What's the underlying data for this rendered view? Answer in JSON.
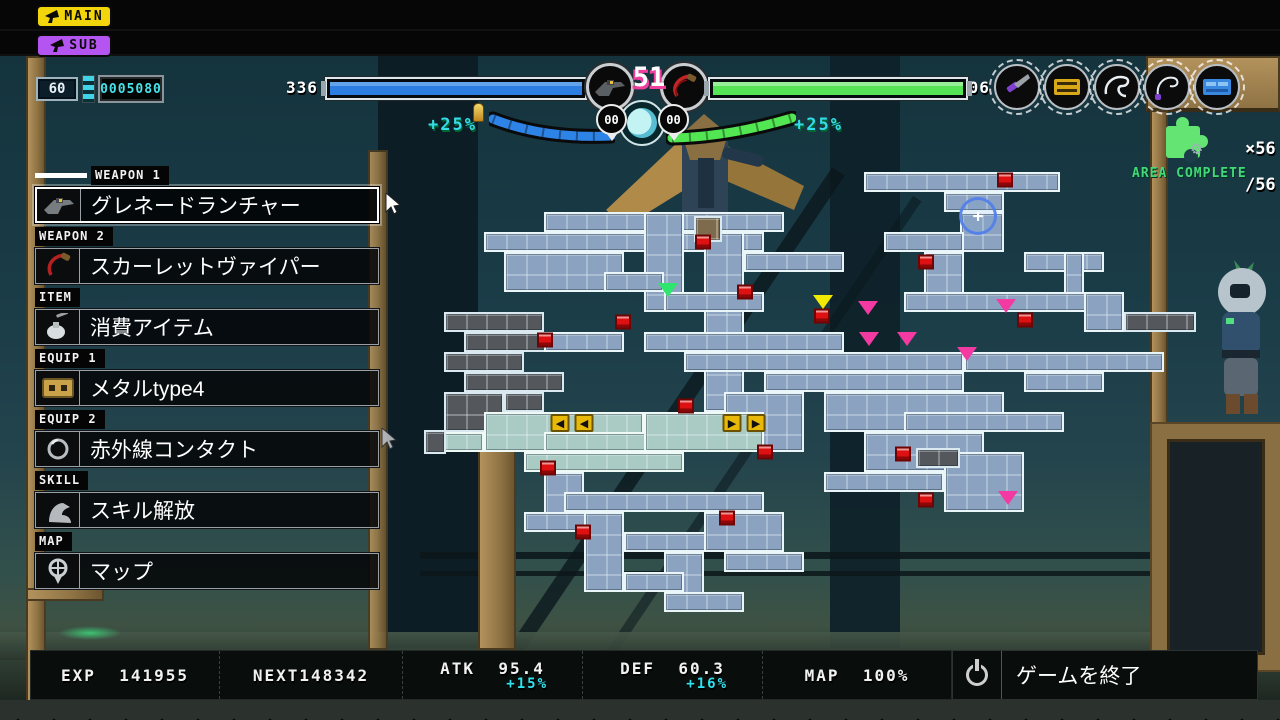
{
  "top_buttons": {
    "main_label": "MAIN",
    "sub_label": "SUB"
  },
  "hud": {
    "level": "60",
    "score_counter": "0005080",
    "ammo_left": "336",
    "ammo_right": "306",
    "center_level": "51",
    "bubble_left": "00",
    "bubble_right": "00",
    "buff_left": "+25%",
    "buff_right": "+25%",
    "colors": {
      "bar_left_fill": "#2b7de0",
      "bar_right_fill": "#55e455",
      "buff_text": "#35dbe8",
      "main_button": "#f2d50a",
      "sub_button": "#b455f2",
      "pink_accent": "#ef3f9e",
      "counter_text": "#46e3ea"
    }
  },
  "area_status": {
    "pieces_count": "×56",
    "pieces_total": "∕56",
    "gear_icon": "⚙",
    "label": "AREA COMPLETE"
  },
  "menu": {
    "sections": [
      {
        "tag": "WEAPON 1",
        "label": "グレネードランチャー",
        "icon": "grenade-launcher",
        "selected": true
      },
      {
        "tag": "WEAPON 2",
        "label": "スカーレットヴァイパー",
        "icon": "red-whip",
        "selected": false
      },
      {
        "tag": "ITEM",
        "label": "消費アイテム",
        "icon": "potion",
        "selected": false
      },
      {
        "tag": "EQUIP 1",
        "label": "メタルtype4",
        "icon": "cassette",
        "selected": false
      },
      {
        "tag": "EQUIP 2",
        "label": "赤外線コンタクト",
        "icon": "contact-lens",
        "selected": false
      },
      {
        "tag": "SKILL",
        "label": "スキル解放",
        "icon": "flex-arm",
        "selected": false
      },
      {
        "tag": "MAP",
        "label": "マップ",
        "icon": "map-pin",
        "selected": false
      }
    ]
  },
  "stats": {
    "exp_label": "EXP",
    "exp_value": "141955",
    "next_label": "NEXT",
    "next_value": "148342",
    "atk_label": "ATK",
    "atk_value": "95.4",
    "atk_buff": "+15%",
    "def_label": "DEF",
    "def_value": "60.3",
    "def_buff": "+16%",
    "map_label": "MAP",
    "map_value": "100%",
    "quit_label": "ゲームを終了"
  },
  "map": {
    "glyphs": {
      "arrL": "◀",
      "arrR": "▶",
      "cursor": "+"
    },
    "rooms": [
      [
        544,
        212,
        240,
        20,
        "b"
      ],
      [
        484,
        232,
        280,
        20,
        "b"
      ],
      [
        504,
        252,
        120,
        40,
        "b"
      ],
      [
        644,
        212,
        40,
        100,
        "b"
      ],
      [
        704,
        232,
        40,
        180,
        "b"
      ],
      [
        744,
        252,
        100,
        20,
        "b"
      ],
      [
        664,
        292,
        100,
        20,
        "b"
      ],
      [
        604,
        272,
        60,
        20,
        "b"
      ],
      [
        694,
        216,
        28,
        26,
        "n"
      ],
      [
        864,
        172,
        196,
        20,
        "b"
      ],
      [
        944,
        192,
        60,
        20,
        "b"
      ],
      [
        960,
        212,
        44,
        40,
        "b"
      ],
      [
        884,
        232,
        80,
        20,
        "b"
      ],
      [
        924,
        252,
        40,
        60,
        "b"
      ],
      [
        1024,
        252,
        80,
        20,
        "b"
      ],
      [
        1064,
        252,
        20,
        60,
        "b"
      ],
      [
        904,
        292,
        200,
        20,
        "b"
      ],
      [
        1084,
        292,
        40,
        40,
        "b"
      ],
      [
        1124,
        312,
        72,
        20,
        "d"
      ],
      [
        444,
        312,
        100,
        20,
        "d"
      ],
      [
        464,
        332,
        120,
        20,
        "d"
      ],
      [
        444,
        352,
        80,
        20,
        "d"
      ],
      [
        464,
        372,
        100,
        20,
        "d"
      ],
      [
        444,
        392,
        60,
        40,
        "d"
      ],
      [
        504,
        392,
        40,
        20,
        "d"
      ],
      [
        544,
        332,
        80,
        20,
        "b"
      ],
      [
        644,
        332,
        200,
        20,
        "b"
      ],
      [
        684,
        352,
        280,
        20,
        "b"
      ],
      [
        764,
        372,
        200,
        20,
        "b"
      ],
      [
        824,
        392,
        180,
        40,
        "b"
      ],
      [
        724,
        392,
        80,
        60,
        "b"
      ],
      [
        964,
        352,
        200,
        20,
        "b"
      ],
      [
        1024,
        372,
        80,
        20,
        "b"
      ],
      [
        904,
        412,
        160,
        20,
        "b"
      ],
      [
        864,
        432,
        120,
        40,
        "b"
      ],
      [
        944,
        452,
        80,
        60,
        "b"
      ],
      [
        824,
        472,
        120,
        20,
        "b"
      ],
      [
        916,
        448,
        44,
        20,
        "d"
      ],
      [
        424,
        432,
        60,
        20,
        "t"
      ],
      [
        424,
        430,
        22,
        24,
        "d"
      ],
      [
        484,
        412,
        160,
        40,
        "t"
      ],
      [
        544,
        432,
        220,
        20,
        "t"
      ],
      [
        644,
        412,
        120,
        40,
        "t"
      ],
      [
        524,
        452,
        160,
        20,
        "t"
      ],
      [
        544,
        472,
        40,
        60,
        "b"
      ],
      [
        564,
        492,
        200,
        20,
        "b"
      ],
      [
        524,
        512,
        80,
        20,
        "b"
      ],
      [
        584,
        512,
        40,
        80,
        "b"
      ],
      [
        624,
        532,
        160,
        20,
        "b"
      ],
      [
        664,
        552,
        40,
        60,
        "b"
      ],
      [
        704,
        512,
        80,
        40,
        "b"
      ],
      [
        724,
        552,
        80,
        20,
        "b"
      ],
      [
        624,
        572,
        60,
        20,
        "b"
      ],
      [
        664,
        592,
        80,
        20,
        "b"
      ]
    ],
    "markers": [
      {
        "t": "save",
        "x": 703,
        "y": 242
      },
      {
        "t": "save",
        "x": 1005,
        "y": 180
      },
      {
        "t": "save",
        "x": 745,
        "y": 292
      },
      {
        "t": "save",
        "x": 926,
        "y": 262
      },
      {
        "t": "save",
        "x": 623,
        "y": 322
      },
      {
        "t": "save",
        "x": 545,
        "y": 340
      },
      {
        "t": "save",
        "x": 822,
        "y": 316
      },
      {
        "t": "save",
        "x": 1025,
        "y": 320
      },
      {
        "t": "save",
        "x": 686,
        "y": 406
      },
      {
        "t": "save",
        "x": 765,
        "y": 452
      },
      {
        "t": "save",
        "x": 548,
        "y": 468
      },
      {
        "t": "save",
        "x": 727,
        "y": 518
      },
      {
        "t": "save",
        "x": 583,
        "y": 532
      },
      {
        "t": "save",
        "x": 903,
        "y": 454
      },
      {
        "t": "save",
        "x": 926,
        "y": 500
      },
      {
        "t": "pink",
        "x": 868,
        "y": 308
      },
      {
        "t": "pink",
        "x": 1006,
        "y": 306
      },
      {
        "t": "pink",
        "x": 869,
        "y": 339
      },
      {
        "t": "pink",
        "x": 907,
        "y": 339
      },
      {
        "t": "pink",
        "x": 967,
        "y": 354
      },
      {
        "t": "pink",
        "x": 1008,
        "y": 498
      },
      {
        "t": "green",
        "x": 668,
        "y": 290
      },
      {
        "t": "yellow",
        "x": 823,
        "y": 302
      },
      {
        "t": "arrL",
        "x": 560,
        "y": 423
      },
      {
        "t": "arrL",
        "x": 584,
        "y": 423
      },
      {
        "t": "arrR",
        "x": 732,
        "y": 423
      },
      {
        "t": "arrR",
        "x": 756,
        "y": 423
      },
      {
        "t": "cursor",
        "x": 978,
        "y": 216
      }
    ]
  }
}
